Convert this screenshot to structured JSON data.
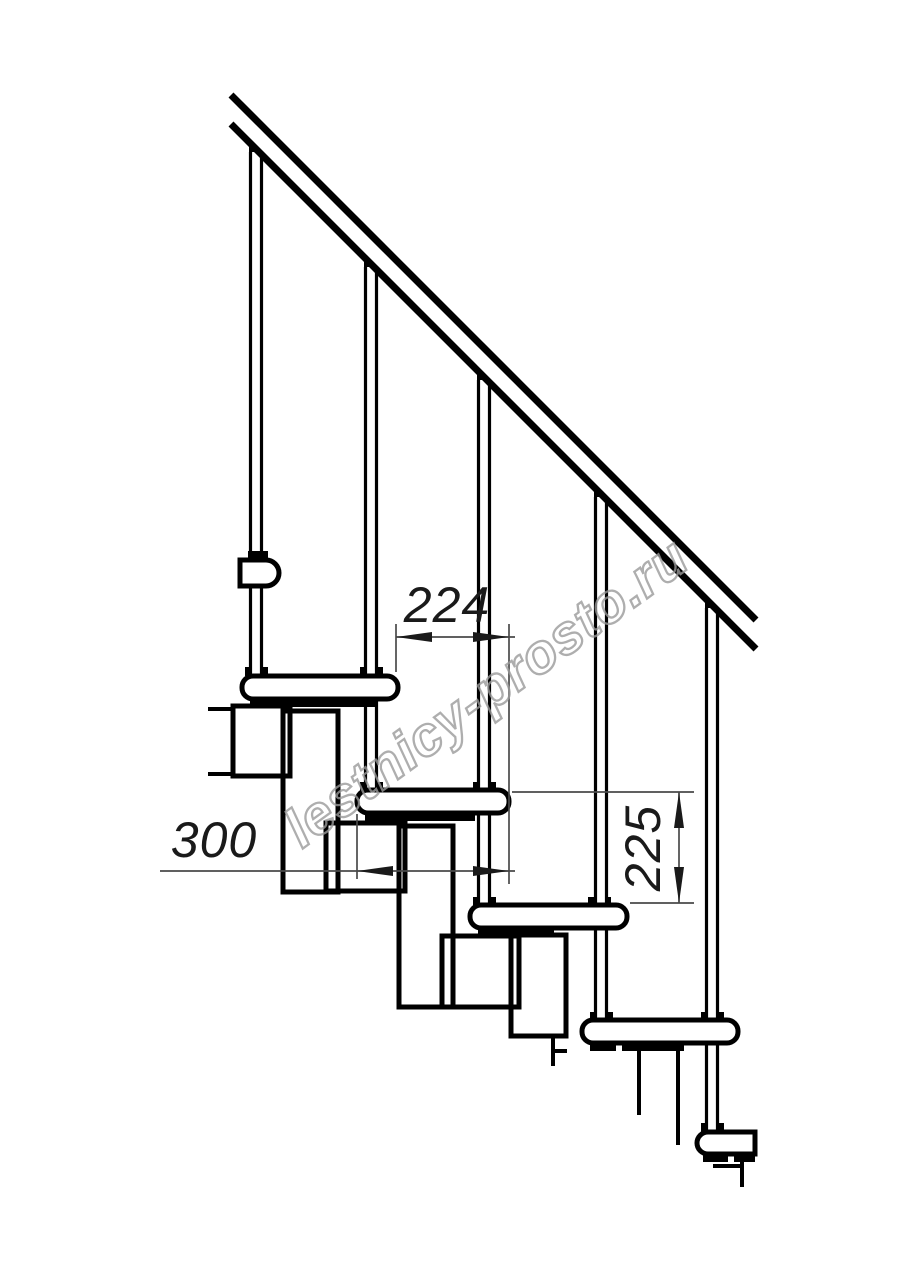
{
  "watermark": {
    "text": "lestnicy-prosto.ru",
    "color": "#9a9a9a"
  },
  "dimensions": {
    "run": {
      "value": "224"
    },
    "depth": {
      "value": "300"
    },
    "rise": {
      "value": "225"
    }
  },
  "colors": {
    "line": "#000000",
    "dimension_line": "#4a4a4a",
    "background": "#ffffff"
  }
}
